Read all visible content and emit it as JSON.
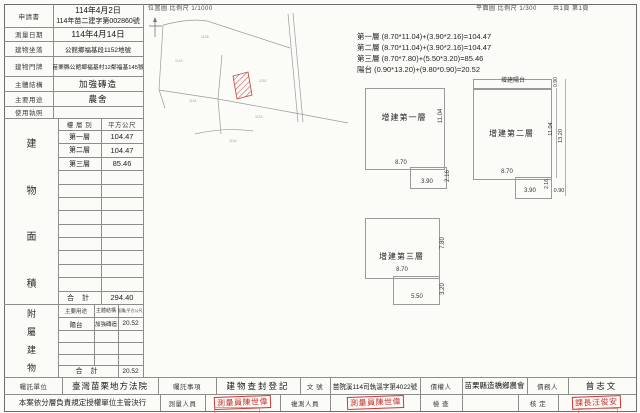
{
  "header": {
    "location_map_title": "位置圖 比例尺 1/1000",
    "plan_title": "平面圖 比例尺 1/300",
    "pages": "共1頁 第1頁"
  },
  "info_table": {
    "rows": [
      {
        "label": "申請書",
        "value": "114年4月2日",
        "value2": "114年苗二建字第002860號"
      },
      {
        "label": "測量日期",
        "value": "114年4月14日"
      },
      {
        "label": "建物坐落",
        "value": "公館鄉福基段1152地號"
      },
      {
        "label": "建物門牌",
        "value": "苗栗縣公館鄉福基村12鄰福基145號"
      },
      {
        "label": "主體結構",
        "value": "加強磚造"
      },
      {
        "label": "主要用途",
        "value": "農舍"
      },
      {
        "label": "使用執照",
        "value": ""
      }
    ]
  },
  "calculations": {
    "line1": "第一層 (8.70*11.04)+(3.90*2.16)=104.47",
    "line2": "第二層 (8.70*11.04)+(3.90*2.16)=104.47",
    "line3": "第三層 (8.70*7.80)+(5.50*3.20)=85.46",
    "line4": "陽台 (0.90*13.20)+(9.80*0.90)=20.52"
  },
  "floor_table": {
    "vertical_label": [
      "建",
      "物",
      "面",
      "積"
    ],
    "col1": "樓 層 別",
    "col2": "平方公尺",
    "rows": [
      {
        "floor": "第一層",
        "area": "104.47"
      },
      {
        "floor": "第二層",
        "area": "104.47"
      },
      {
        "floor": "第三層",
        "area": "85.46"
      }
    ],
    "total_label": "合 計",
    "total": "294.40"
  },
  "annex_table": {
    "vertical_label": [
      "附",
      "屬",
      "建",
      "物"
    ],
    "col1": "主要用途",
    "col2": "主體結構",
    "col3": "面積(平方公尺)",
    "rows": [
      {
        "use": "陽台",
        "structure": "加強磚造",
        "area": "20.52"
      }
    ],
    "total_label": "合 計",
    "total": "20.52"
  },
  "location_map": {
    "parcels": [
      "1148",
      "1149",
      "1151",
      "1152",
      "1153",
      "1154"
    ]
  },
  "plans": {
    "p1": {
      "label": "增建第一層",
      "h": "11.04",
      "w": "8.70",
      "ext_w": "3.90",
      "ext_h": "2.16"
    },
    "p2": {
      "label": "增建第二層",
      "balcony": "增建陽台",
      "balcony_h": "0.90",
      "h": "11.04",
      "total_h": "13.20",
      "w": "8.70",
      "ext_w": "3.90",
      "ext_h": "2.16",
      "corner_w": "0.90"
    },
    "p3": {
      "label": "增建第三層",
      "h": "7.80",
      "w": "8.70",
      "ext_w": "5.50",
      "ext_h": "3.20"
    }
  },
  "footer": {
    "row1": [
      {
        "label": "囑託單位",
        "value": "臺灣苗栗地方法院"
      },
      {
        "label": "囑託事項",
        "value": "建物查封登記"
      },
      {
        "label": "文 號",
        "value": "苗院溪114司執溫字第4022號"
      },
      {
        "label": "債權人",
        "value": "苗栗縣造橋鄉農會"
      },
      {
        "label": "債務人",
        "value": "曾志文"
      }
    ],
    "row2": {
      "note": "本案依分層負責規定授權單位主管決行",
      "surveyor_label": "測量人員",
      "resurvey_label": "複測人員",
      "check_label": "檢 查",
      "approve_label": "核 定",
      "stamp1": "測量員陳世偉",
      "stamp2": "測量員陳世偉",
      "stamp3": "課長汪俊安"
    }
  }
}
